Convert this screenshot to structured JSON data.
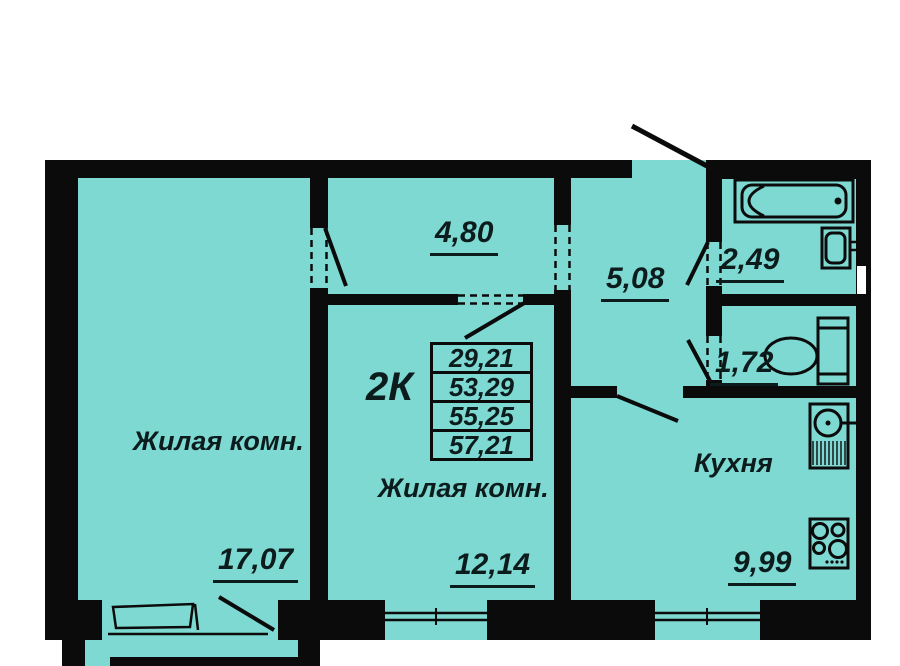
{
  "plan": {
    "apartment_type": "2К",
    "info_table": {
      "values": [
        "29,21",
        "53,29",
        "55,25",
        "57,21"
      ]
    },
    "rooms": {
      "living1": {
        "label": "Жилая комн.",
        "area": "17,07"
      },
      "living2": {
        "label": "Жилая комн.",
        "area": "12,14"
      },
      "kitchen": {
        "label": "Кухня",
        "area": "9,99"
      },
      "corridor": {
        "area": "4,80"
      },
      "hallway": {
        "area": "5,08"
      },
      "bathroom": {
        "area": "2,49"
      },
      "wc": {
        "area": "1,72"
      }
    },
    "colors": {
      "floor": "#7dd9d2",
      "wall": "#0b0b0b",
      "text": "#0c1c1c",
      "outside": "#ffffff"
    }
  }
}
